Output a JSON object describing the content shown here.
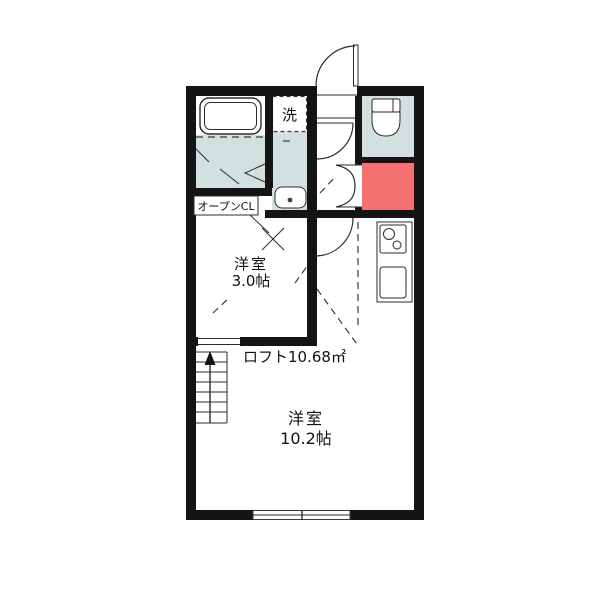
{
  "plan": {
    "labels": {
      "laundry": "洗",
      "open_closet": "オープンCL",
      "small_room_name": "洋室",
      "small_room_size": "3.0帖",
      "loft_area": "ロフト10.68㎡",
      "main_room_name": "洋室",
      "main_room_size": "10.2帖"
    },
    "colors": {
      "wet_area": "#d2e0e0",
      "accent_red": "#f57070",
      "wall": "#141414"
    },
    "icons": {
      "bathtub-icon": "rounded rectangle tub",
      "washing-machine-pan-icon": "dashed square",
      "washbasin-icon": "rounded sink with drain dot",
      "toilet-icon": "tank and bowl",
      "stove-icon": "two burner circles",
      "kitchen-sink-icon": "rounded square",
      "stairs-icon": "treads with up arrow",
      "entrance-door-icon": "quarter-circle swing",
      "window-icon": "double line in wall"
    }
  }
}
